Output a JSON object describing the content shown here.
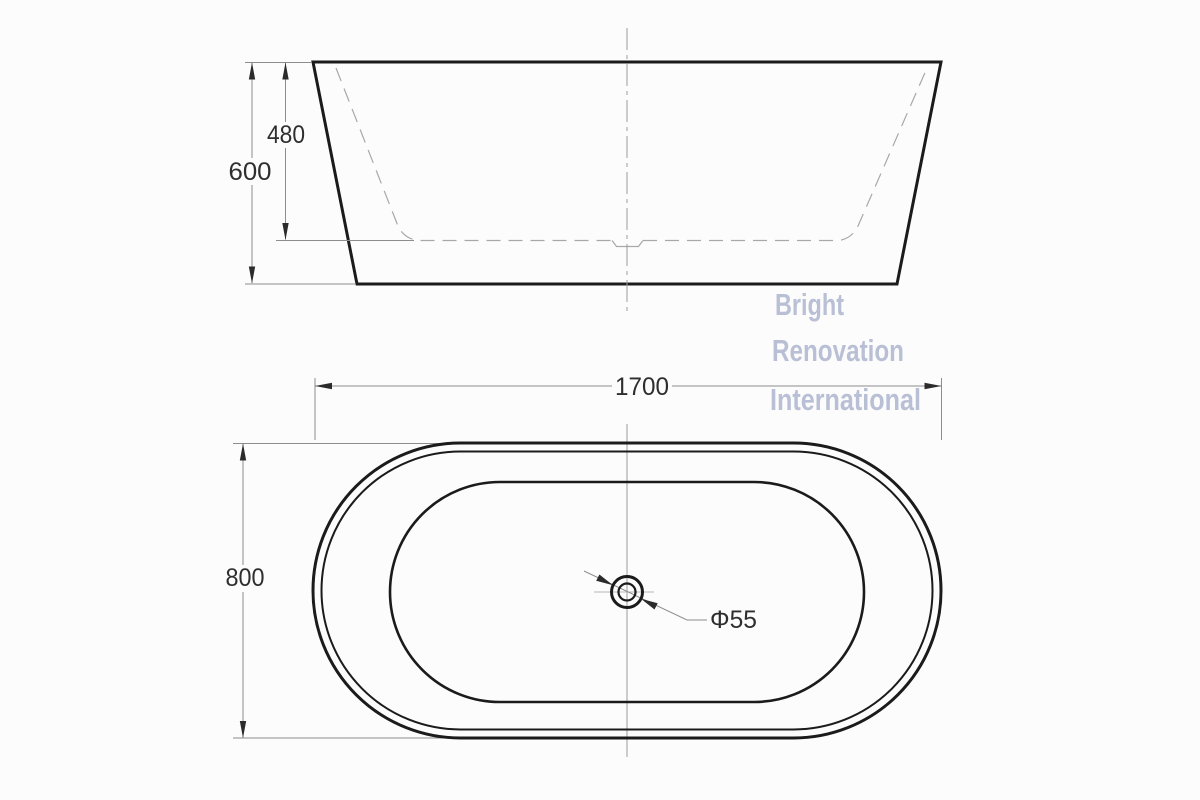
{
  "front_view": {
    "overall_height": "600",
    "inner_depth": "480"
  },
  "top_view": {
    "overall_length": "1700",
    "overall_width": "800",
    "drain_diameter": "Φ55"
  },
  "watermark": {
    "line1": "Bright",
    "line2": "Renovation",
    "line3": "International"
  },
  "colors": {
    "background": "#fcfcfc",
    "outline": "#1b1b1b",
    "dimension_line": "#8d8d8d",
    "dimension_text": "#2e2e2e",
    "hidden_line": "#a8a8a8",
    "centerline": "#9b9b9b",
    "watermark": "#b4bbd3"
  }
}
